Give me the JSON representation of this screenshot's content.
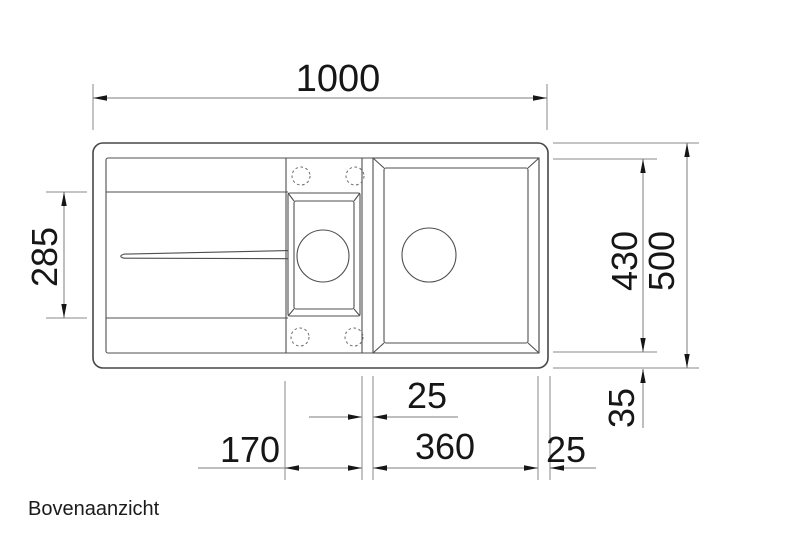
{
  "title": {
    "label": "Bovenaanzicht"
  },
  "drawing": {
    "type": "technical-dimension-drawing",
    "subject": "kitchen sink top view with drainer, half bowl and main bowl",
    "units": "mm",
    "colors": {
      "background": "#ffffff",
      "drawing_lines": "#4f4f4f",
      "dimension_lines": "#7d7d7d",
      "text_and_arrows": "#161616"
    }
  },
  "dims": {
    "overall_width": "1000",
    "drainer_depth": "285",
    "bowl_depth": "430",
    "overall_depth": "500",
    "rear_rim": "35",
    "divider_width": "25",
    "half_bowl_module": "170",
    "main_bowl_width": "360",
    "side_rim": "25"
  }
}
